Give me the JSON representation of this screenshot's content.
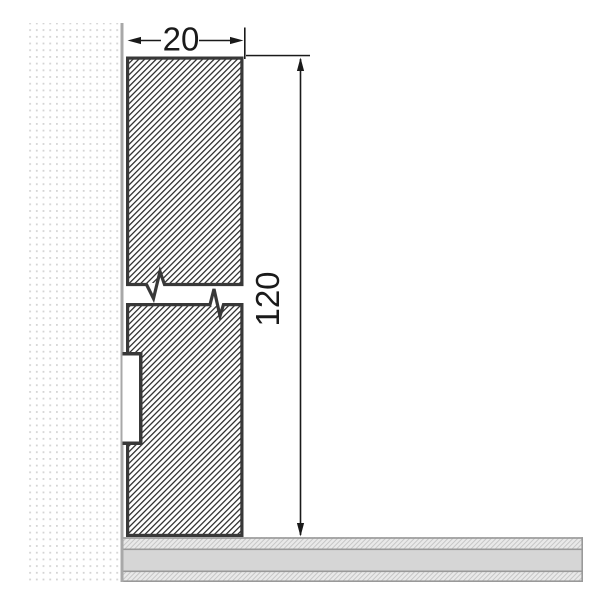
{
  "dimensions": {
    "width": {
      "label": "20"
    },
    "height": {
      "label": "120"
    }
  },
  "colors": {
    "background": "#ffffff",
    "wall_dot": "#d4d4d4",
    "wall_edge": "#a8a8a8",
    "profile_outline": "#383838",
    "profile_hatch": "#2b2b2b",
    "floor_hatch_bg": "#e9e9e9",
    "floor_hatch_line": "#c6c6c6",
    "floor_core": "#d6d6d6",
    "floor_line": "#999999",
    "dimension_line": "#1a1a1a"
  }
}
